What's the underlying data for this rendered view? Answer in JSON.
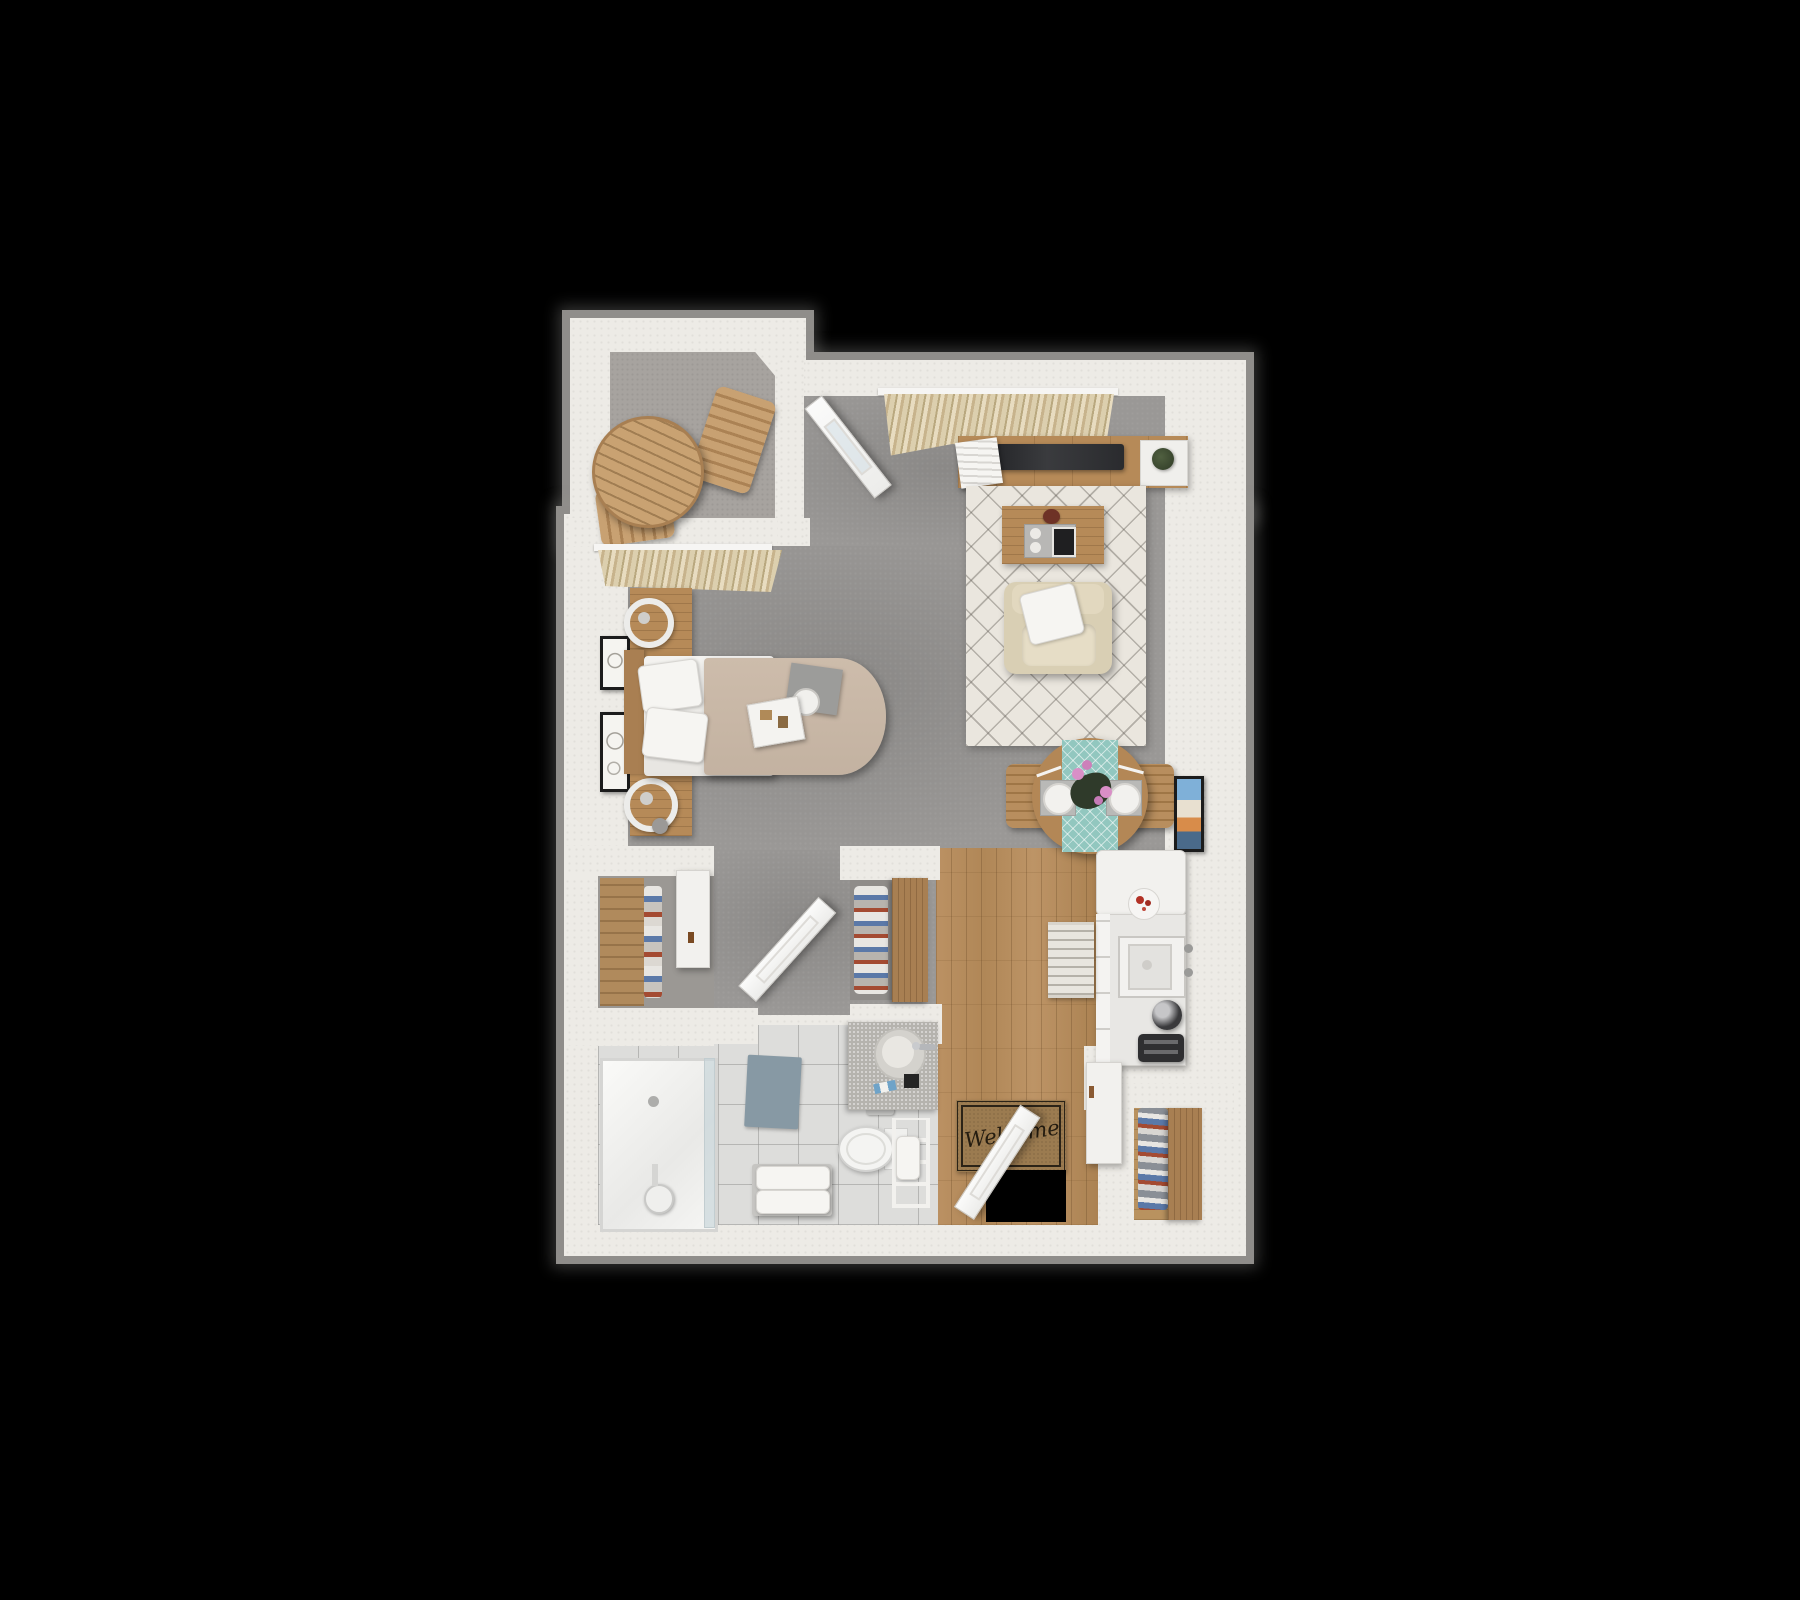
{
  "scene": {
    "kind": "3d-top-view-floor-plan",
    "unit_type": "studio-apartment",
    "background": "#000000"
  },
  "entry": {
    "welcome_mat_text": "Welcome"
  },
  "palette": {
    "outer_shadow": "#8f8d8a",
    "wall": "#edebe6",
    "carpet_main": "#9a9896",
    "carpet_balcony": "#a7a39f",
    "wood_floor": "#b68a58",
    "tile_floor": "#dddddb",
    "rug_cream": "#eae6de",
    "runner_teal": "#92c7bf",
    "furniture_wood": "#b68a58",
    "upholstery_cream": "#ddd3b8",
    "bedding_tan": "#c9b8a8",
    "mat_brown": "#9b7b50",
    "tv_dark": "#2e2f31",
    "accent_flower_pink": "#d98fc7",
    "accent_bowl_red": "#b33226"
  },
  "rooms": [
    {
      "id": "balcony",
      "furniture": [
        "round-patio-table",
        "patio-chair",
        "patio-chair"
      ]
    },
    {
      "id": "sleeping-area",
      "furniture": [
        "bed",
        "pillows",
        "headboard",
        "nightstand",
        "ring-lamp",
        "nightstand",
        "ring-lamp",
        "wall-art",
        "wall-art",
        "breakfast-tray",
        "book"
      ]
    },
    {
      "id": "living-area",
      "furniture": [
        "tv-console",
        "tv",
        "magazines",
        "plant",
        "area-rug",
        "coffee-table",
        "decor-tray",
        "bowl",
        "armchair",
        "throw-pillow",
        "window-curtains",
        "patio-door"
      ]
    },
    {
      "id": "dining-area",
      "furniture": [
        "round-dining-table",
        "table-runner",
        "dining-chair",
        "dining-chair",
        "place-setting",
        "place-setting",
        "flower-centerpiece",
        "leaning-wall-art"
      ]
    },
    {
      "id": "kitchenette",
      "furniture": [
        "refrigerator",
        "counter",
        "cabinet-fronts",
        "decor-plate",
        "oven-stove",
        "coffee-maker",
        "toaster",
        "kitchen-runner-rug",
        "lower-cabinet"
      ]
    },
    {
      "id": "entryway",
      "furniture": [
        "welcome-mat",
        "entry-door",
        "doorway-opening"
      ]
    },
    {
      "id": "bathroom",
      "furniture": [
        "walk-in-shower",
        "shower-column",
        "glass-panel",
        "bath-mat",
        "towel-bench",
        "toilet",
        "toilet-paper-holder",
        "vanity-sink",
        "faucet",
        "towel-ladder",
        "bathroom-door"
      ]
    },
    {
      "id": "bedroom-closet",
      "furniture": [
        "closet-shelves",
        "hanging-clothes",
        "white-sliding-door",
        "wall-cabinet-panel"
      ]
    },
    {
      "id": "entry-closet",
      "furniture": [
        "hanging-clothes",
        "wood-sliding-door"
      ]
    },
    {
      "id": "shoe-closet",
      "furniture": [
        "shoe-rack",
        "wood-sliding-door"
      ]
    }
  ]
}
